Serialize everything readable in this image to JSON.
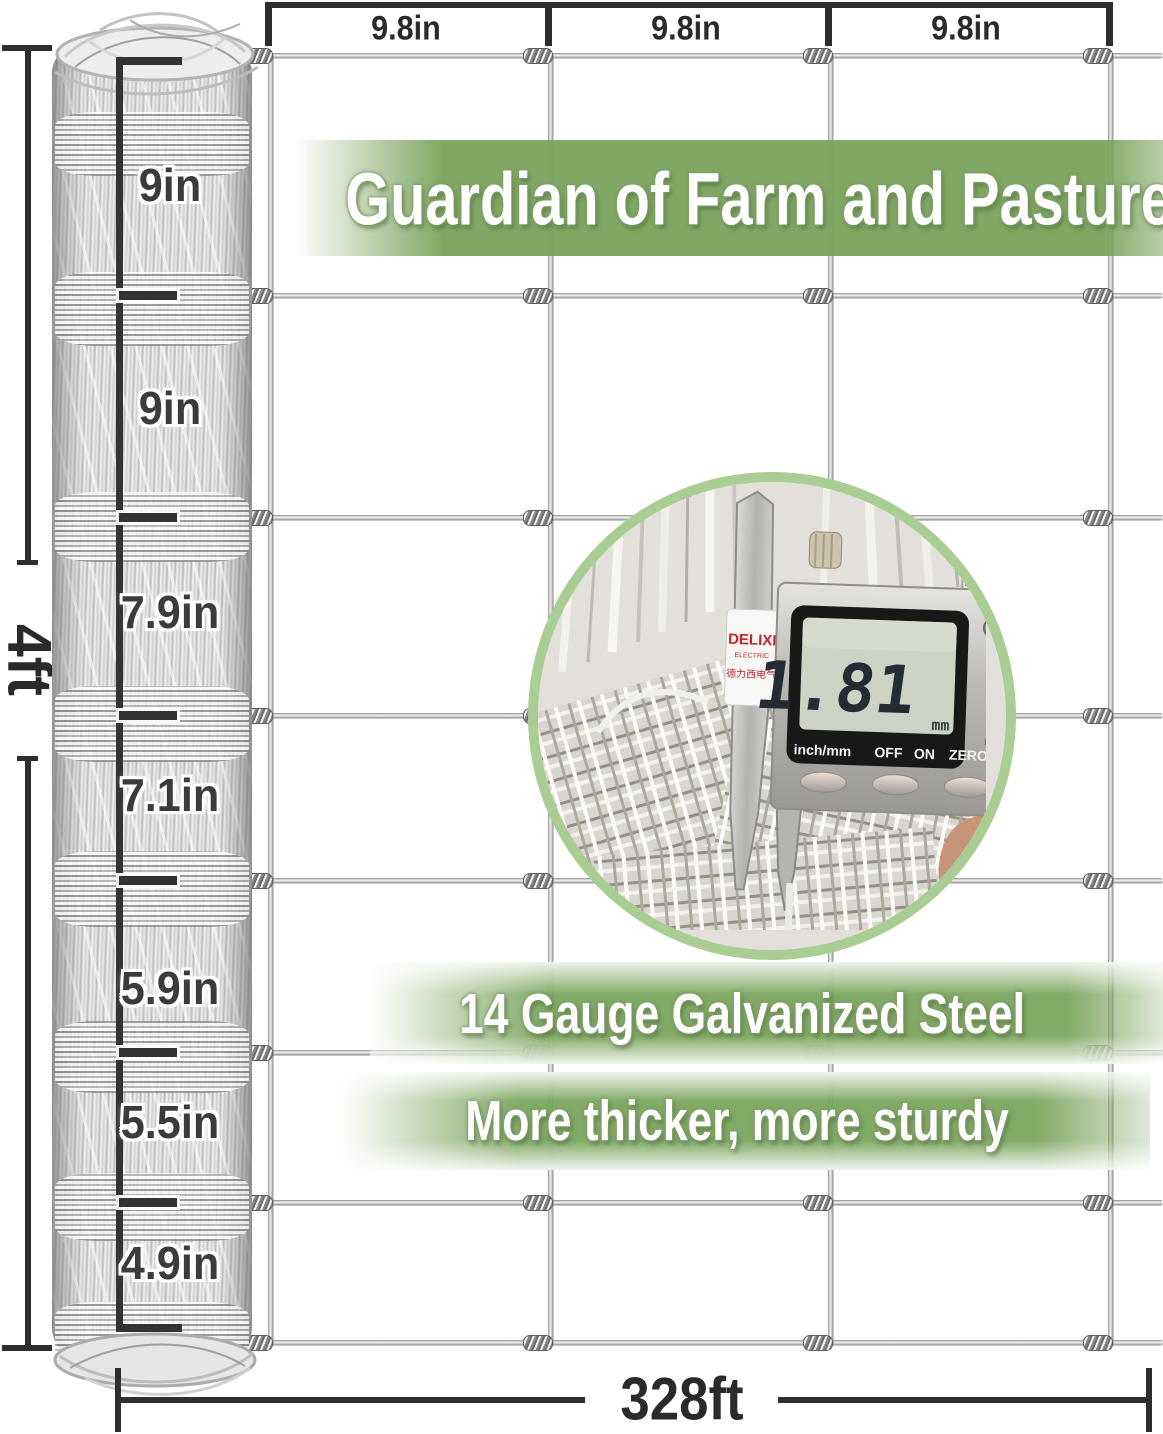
{
  "product_annotations": {
    "column_spacing_labels": [
      "9.8in",
      "9.8in",
      "9.8in"
    ],
    "roll_height_label": "4ft",
    "roll_length_label": "328ft",
    "row_spacing_labels": [
      "9in",
      "9in",
      "7.9in",
      "7.1in",
      "5.9in",
      "5.5in",
      "4.9in"
    ]
  },
  "banners": {
    "headline": "Guardian of Farm and Pasture",
    "feature_1": "14 Gauge Galvanized Steel",
    "feature_2": "More thicker, more sturdy"
  },
  "caliper_inset": {
    "brand": "DELIXI",
    "brand_sub": "ELECTRIC",
    "brand_cn": "德力西电气",
    "display_value": "1.81",
    "display_unit": "mm",
    "buttons": [
      "inch/mm",
      "OFF",
      "ON",
      "ZERO"
    ]
  },
  "colors": {
    "banner_green": "#7CA55F",
    "dimension_ink": "#2e2e2e",
    "circle_border": "#A9CD92",
    "lcd_screen": "#CCD3C4",
    "brand_red": "#C0272D"
  }
}
